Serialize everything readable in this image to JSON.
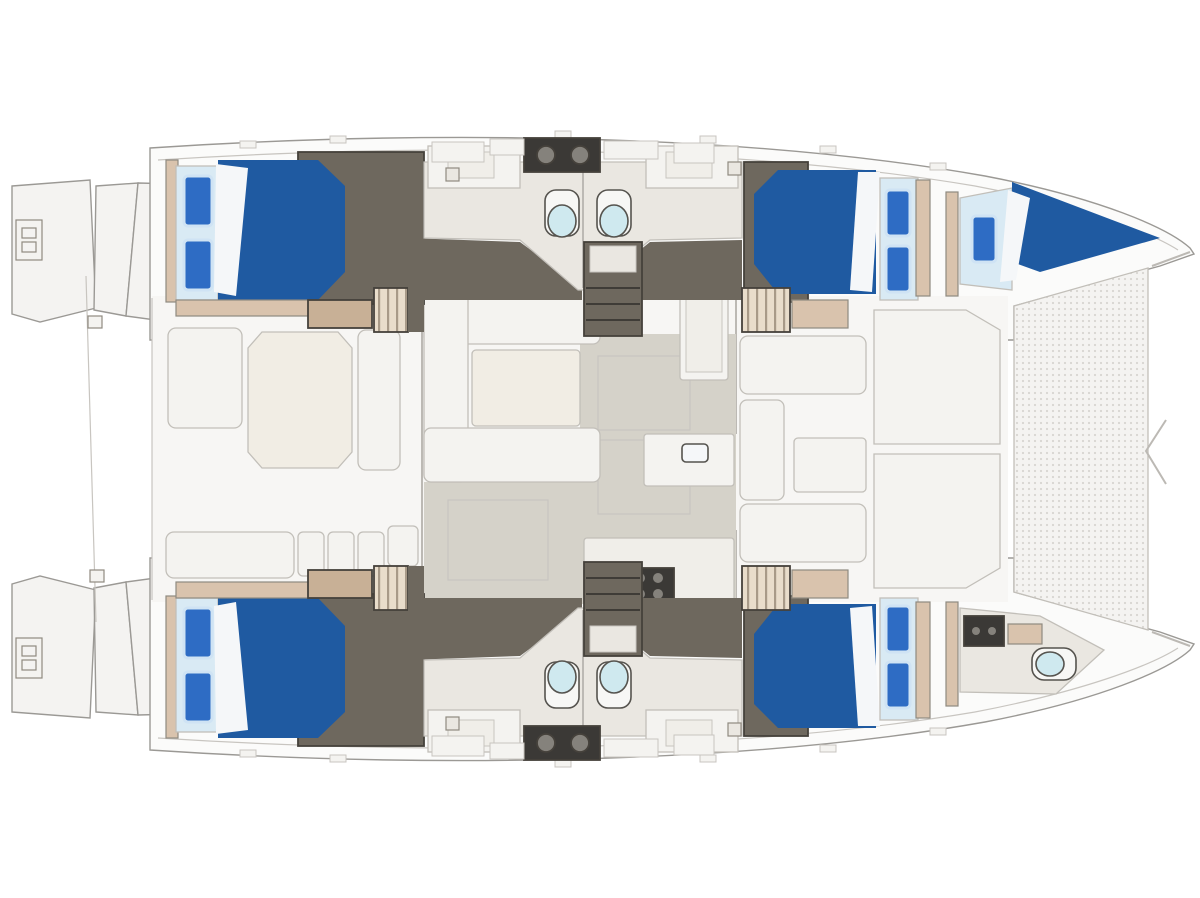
{
  "title": "Catamaran layout plan (top view)",
  "orientation": {
    "bow": "right",
    "stern": "left"
  },
  "colors": {
    "background": "#ffffff",
    "hull_fill": "#fbfbfa",
    "platform_fill": "#f4f3f1",
    "bridgedeck_fill": "#f7f6f4",
    "wood_trim": "#d9c3ad",
    "wood_shelf": "#c8b096",
    "stair_tread": "#e9ddcb",
    "stair_stripe": "#a89a88",
    "floor_dark": "#6e685e",
    "heads_floor": "#eae7e1",
    "salon_floor": "#d5d2c9",
    "counter_white": "#f0eee9",
    "furniture_white": "#f4f3f0",
    "table_fill": "#f1ede4",
    "duvet_blue": "#1f5aa1",
    "pillow_blue": "#2e6cc4",
    "pillow_edge": "#cfe3f4",
    "mattress_blue": "#d9eaf4",
    "sheet_white": "#f5f7f9",
    "toilet_lid": "#cfe9ef",
    "toilet_body": "#f7f7f5",
    "appliance_dark": "#3b3936",
    "appliance_detail": "#85827c",
    "mesh_fill": "#f4f3f1",
    "mesh_dot": "#d7d5d1"
  },
  "regions": [
    {
      "id": "aft-cockpit",
      "label": "Aft cockpit with dining table and bench seating"
    },
    {
      "id": "salon",
      "label": "Salon with U-shaped settee, table and galley"
    },
    {
      "id": "port-aft-cabin",
      "label": "Port aft double cabin"
    },
    {
      "id": "port-fwd-cabin",
      "label": "Port forward double cabin"
    },
    {
      "id": "starboard-aft-cabin",
      "label": "Starboard aft double cabin"
    },
    {
      "id": "starboard-fwd-cabin",
      "label": "Starboard forward double cabin"
    },
    {
      "id": "port-heads",
      "label": "Two port bathrooms with toilets, showers and twin-sink vanity"
    },
    {
      "id": "starboard-heads",
      "label": "Two starboard bathrooms with toilets, showers and twin-sink vanity"
    },
    {
      "id": "port-forepeak-berth",
      "label": "Port bow crew berth"
    },
    {
      "id": "starboard-bow-head",
      "label": "Starboard bow crew head with toilet"
    },
    {
      "id": "bow-trampoline",
      "label": "Bow trampoline net between hulls"
    },
    {
      "id": "foredeck-lounge",
      "label": "Forward cockpit seating and sun pads"
    },
    {
      "id": "stern-platforms",
      "label": "Twin transom steps, swim platforms and ladders"
    }
  ],
  "counts": {
    "double_berths": 4,
    "bow_berths": 1,
    "pillows": 9,
    "toilets": 5,
    "bathrooms": 5,
    "companionway_stairs": 4,
    "central_stair_flights": 2,
    "swim_ladders": 2
  }
}
